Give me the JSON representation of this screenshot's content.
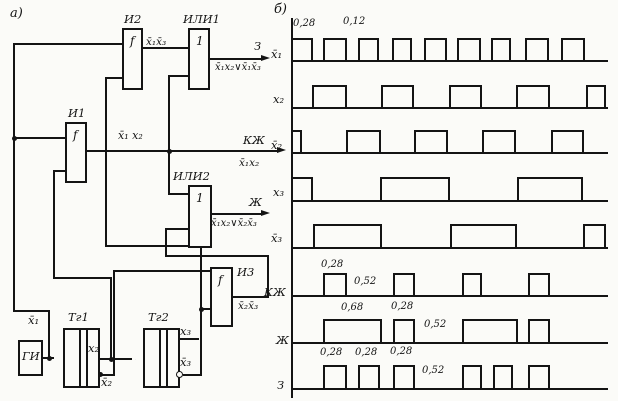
{
  "panel_a_label": "а)",
  "panel_b_label": "б)",
  "circuit": {
    "blocks": [
      {
        "id": "gi",
        "caption": "ГИ",
        "symbol": "",
        "caption_inside": true
      },
      {
        "id": "tg1",
        "caption": "Тг1",
        "symbol": ""
      },
      {
        "id": "tg2",
        "caption": "Тг2",
        "symbol": ""
      },
      {
        "id": "i1",
        "caption": "И1",
        "symbol": "f"
      },
      {
        "id": "i2",
        "caption": "И2",
        "symbol": "f"
      },
      {
        "id": "ili1",
        "caption": "ИЛИ1",
        "symbol": "1"
      },
      {
        "id": "ili2",
        "caption": "ИЛИ2",
        "symbol": "1"
      },
      {
        "id": "i3",
        "caption": "И3",
        "symbol": "f"
      }
    ],
    "labels": [
      {
        "name": "label-x1bar-gen",
        "text": "x̄₁",
        "x": 28,
        "y": 314,
        "size": 11.5
      },
      {
        "name": "label-x2-out",
        "text": "x₂",
        "x": 88,
        "y": 342,
        "size": 11.5
      },
      {
        "name": "label-x2bar-out",
        "text": "x̄₂",
        "x": 101,
        "y": 376,
        "size": 11.5
      },
      {
        "name": "label-x3-out",
        "text": "x₃",
        "x": 180,
        "y": 325,
        "size": 11.5
      },
      {
        "name": "label-x3bar-out",
        "text": "x̄₃",
        "x": 180,
        "y": 356,
        "size": 11.5
      },
      {
        "name": "label-and2-out",
        "text": "x̄₁x̄₃",
        "x": 146,
        "y": 36,
        "size": 10.5
      },
      {
        "name": "label-and1-out",
        "text": "x̄₁ x₂",
        "x": 118,
        "y": 130,
        "size": 11
      },
      {
        "name": "label-green-out",
        "text": "З",
        "x": 254,
        "y": 40,
        "size": 11.5
      },
      {
        "name": "label-green-formula",
        "text": "x̄₁x₂∨x̄₁x̄₃",
        "x": 215,
        "y": 62,
        "size": 10
      },
      {
        "name": "label-redyellow-out",
        "text": "КЖ",
        "x": 243,
        "y": 134,
        "size": 11.5
      },
      {
        "name": "label-redyellow-formula",
        "text": "x̄₁x₂",
        "x": 239,
        "y": 157,
        "size": 10.5
      },
      {
        "name": "label-yellow-out",
        "text": "Ж",
        "x": 249,
        "y": 196,
        "size": 11.5
      },
      {
        "name": "label-yellow-formula",
        "text": "x̄₁x₂∨x̄₂x̄₃",
        "x": 211,
        "y": 218,
        "size": 10
      },
      {
        "name": "label-and3-out",
        "text": "x̄₂x̄₃",
        "x": 238,
        "y": 300,
        "size": 10.5
      }
    ]
  },
  "chart_data": {
    "type": "timing",
    "title": "",
    "axis_x_px": 291,
    "axis_end_px": 606,
    "rows": [
      {
        "label": "x̄₁",
        "base_y": 60,
        "top_y": 38,
        "pulses": [
          [
            291,
            313
          ],
          [
            323,
            347
          ],
          [
            358,
            379
          ],
          [
            392,
            412
          ],
          [
            424,
            447
          ],
          [
            457,
            481
          ],
          [
            491,
            511
          ],
          [
            525,
            549
          ],
          [
            561,
            585
          ]
        ],
        "annotations": [
          {
            "text": "0,28",
            "x": 293,
            "y": 19
          },
          {
            "text": "0,12",
            "x": 343,
            "y": 17
          }
        ],
        "label_x": 271,
        "label_y": 48
      },
      {
        "label": "x₂",
        "base_y": 107,
        "top_y": 85,
        "pulses": [
          [
            312,
            347
          ],
          [
            381,
            414
          ],
          [
            449,
            482
          ],
          [
            516,
            550
          ],
          [
            586,
            606
          ]
        ],
        "annotations": [],
        "label_x": 273,
        "label_y": 93
      },
      {
        "label": "x̄₂",
        "base_y": 152,
        "top_y": 130,
        "pulses": [
          [
            291,
            302
          ],
          [
            346,
            381
          ],
          [
            414,
            448
          ],
          [
            482,
            516
          ],
          [
            551,
            584
          ]
        ],
        "annotations": [],
        "label_x": 271,
        "label_y": 139
      },
      {
        "label": "x₃",
        "base_y": 200,
        "top_y": 177,
        "pulses": [
          [
            291,
            313
          ],
          [
            380,
            450
          ],
          [
            517,
            583
          ]
        ],
        "annotations": [],
        "label_x": 273,
        "label_y": 186
      },
      {
        "label": "x̄₃",
        "base_y": 247,
        "top_y": 224,
        "pulses": [
          [
            313,
            382
          ],
          [
            450,
            517
          ],
          [
            583,
            606
          ]
        ],
        "annotations": [],
        "label_x": 271,
        "label_y": 232
      },
      {
        "label": "КЖ",
        "base_y": 295,
        "top_y": 273,
        "pulses": [
          [
            323,
            347
          ],
          [
            393,
            415
          ],
          [
            462,
            482
          ],
          [
            528,
            550
          ]
        ],
        "annotations": [
          {
            "text": "0,28",
            "x": 321,
            "y": 260
          },
          {
            "text": "0,52",
            "x": 354,
            "y": 277
          }
        ],
        "label_x": 264,
        "label_y": 286
      },
      {
        "label": "Ж",
        "base_y": 342,
        "top_y": 319,
        "pulses": [
          [
            323,
            382
          ],
          [
            393,
            415
          ],
          [
            462,
            518
          ],
          [
            528,
            550
          ]
        ],
        "annotations": [
          {
            "text": "0,68",
            "x": 341,
            "y": 303
          },
          {
            "text": "0,28",
            "x": 391,
            "y": 302
          },
          {
            "text": "0,52",
            "x": 424,
            "y": 320
          }
        ],
        "label_x": 276,
        "label_y": 334
      },
      {
        "label": "З",
        "base_y": 388,
        "top_y": 365,
        "pulses": [
          [
            323,
            347
          ],
          [
            358,
            380
          ],
          [
            393,
            415
          ],
          [
            462,
            482
          ],
          [
            493,
            513
          ],
          [
            528,
            550
          ]
        ],
        "annotations": [
          {
            "text": "0,28",
            "x": 320,
            "y": 348
          },
          {
            "text": "0,28",
            "x": 355,
            "y": 348
          },
          {
            "text": "0,28",
            "x": 390,
            "y": 347
          },
          {
            "text": "0,52",
            "x": 422,
            "y": 366
          }
        ],
        "label_x": 277,
        "label_y": 379
      }
    ]
  }
}
